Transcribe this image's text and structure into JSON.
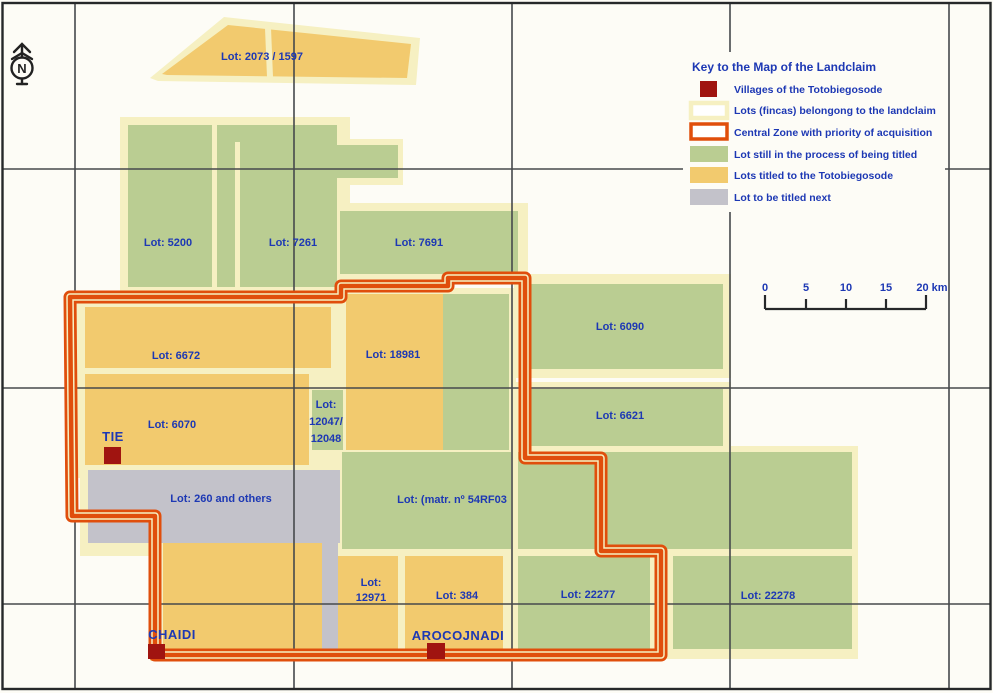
{
  "colors": {
    "background": "#fdfcf6",
    "paper_white": "#fdfcf6",
    "grid_line": "#46494c",
    "border_black": "#26282a",
    "cream_lot_border": "#f6f0c2",
    "central_zone_orange": "#e04e0c",
    "green_lot": "#bacd92",
    "yellow_lot": "#f2ca6e",
    "gray_lot": "#c3c2ca",
    "village_red": "#a01410",
    "label_blue": "#1d38b4",
    "compass_black": "#222222"
  },
  "compass": {
    "label": "N"
  },
  "legend": {
    "title": "Key to the Map of the Landclaim",
    "items": [
      {
        "swatch": "village-square",
        "label": "Villages of the Totobiegosode"
      },
      {
        "swatch": "lots-outline",
        "label": "Lots (fincas) belongong to the landclaim"
      },
      {
        "swatch": "central-zone",
        "label": "Central Zone with priority of acquisition"
      },
      {
        "swatch": "green-fill",
        "label": "Lot still in the process of being titled"
      },
      {
        "swatch": "yellow-fill",
        "label": "Lots titled to the Totobiegosode"
      },
      {
        "swatch": "gray-fill",
        "label": "Lot to be titled next"
      }
    ]
  },
  "scale_bar": {
    "ticks": [
      "0",
      "5",
      "10",
      "15"
    ],
    "end_label": "20 km"
  },
  "villages": [
    {
      "name": "TIE"
    },
    {
      "name": "CHAIDI"
    },
    {
      "name": "AROCOJNADI"
    }
  ],
  "lots": [
    {
      "label": "Lot: 2073 / 1597",
      "status": "titled"
    },
    {
      "label": "Lot: 5200",
      "status": "in-process"
    },
    {
      "label": "Lot: 7261",
      "status": "in-process"
    },
    {
      "label": "Lot: 7691",
      "status": "in-process"
    },
    {
      "label": "Lot: 6672",
      "status": "titled"
    },
    {
      "label": "Lot: 18981",
      "status": "titled"
    },
    {
      "label": "Lot: 6090",
      "status": "in-process"
    },
    {
      "label": "Lot: 6070",
      "status": "titled"
    },
    {
      "lines": [
        "Lot:",
        "12047/",
        "12048"
      ],
      "status": "in-process"
    },
    {
      "label": "Lot: 6621",
      "status": "in-process"
    },
    {
      "label": "Lot: 260 and others",
      "status": "to-be-titled-next"
    },
    {
      "label": "Lot: (matr. nº 54RF03",
      "status": "in-process"
    },
    {
      "lines": [
        "Lot:",
        "12971"
      ],
      "status": "titled"
    },
    {
      "label": "Lot: 384",
      "status": "titled"
    },
    {
      "label": "Lot: 22277",
      "status": "in-process"
    },
    {
      "label": "Lot: 22278",
      "status": "in-process"
    }
  ]
}
